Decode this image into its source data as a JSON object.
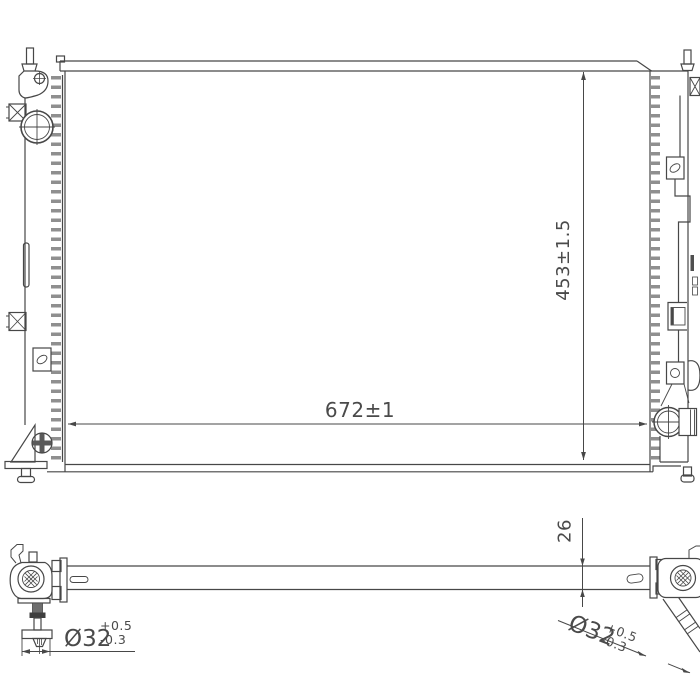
{
  "colors": {
    "ink": "#474747",
    "teeth": "#8f8f8f",
    "background": "#ffffff"
  },
  "front_view": {
    "width_dimension": "672±1",
    "height_dimension": "453±1.5"
  },
  "bottom_view": {
    "thickness_dimension": "26",
    "inlet_diameter": {
      "nominal": "Ø32",
      "upper_tolerance": "+0.5",
      "lower_tolerance": "-0.3"
    },
    "outlet_diameter": {
      "nominal": "Ø32",
      "upper_tolerance": "+0.5",
      "lower_tolerance": "-0.3"
    }
  }
}
